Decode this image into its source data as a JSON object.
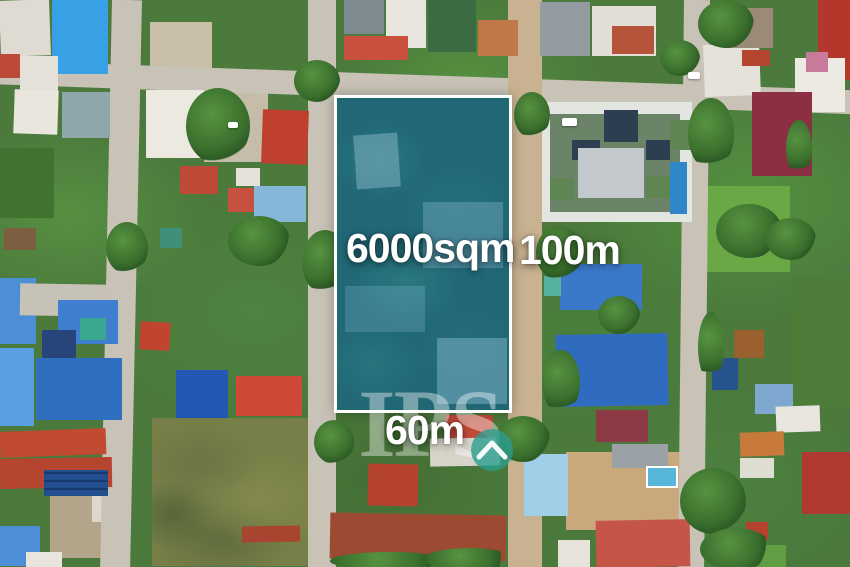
{
  "photo": {
    "description": "Aerial drone photograph of a residential neighborhood; a vacant 6000sqm land plot is highlighted with a white outline and blue-teal overlay between two streets, surrounded by houses with red, blue, white and grey roofs."
  },
  "annotations": {
    "area_label": "6000sqm",
    "side_label_right": "100m",
    "side_label_bottom": "60m"
  },
  "watermark": {
    "text": "IPS",
    "icon": "house-chevron-in-circle"
  },
  "colors": {
    "label_text": "#ffffff",
    "plot_border": "#ffffff",
    "plot_overlay": "#1565a8",
    "watermark_tint": "rgba(255,255,255,0.40)",
    "watermark_icon": "#2a9d8f",
    "road": "#c9c3b7",
    "dirt_road": "#c9b291",
    "vegetation": "#4b7a3c"
  }
}
